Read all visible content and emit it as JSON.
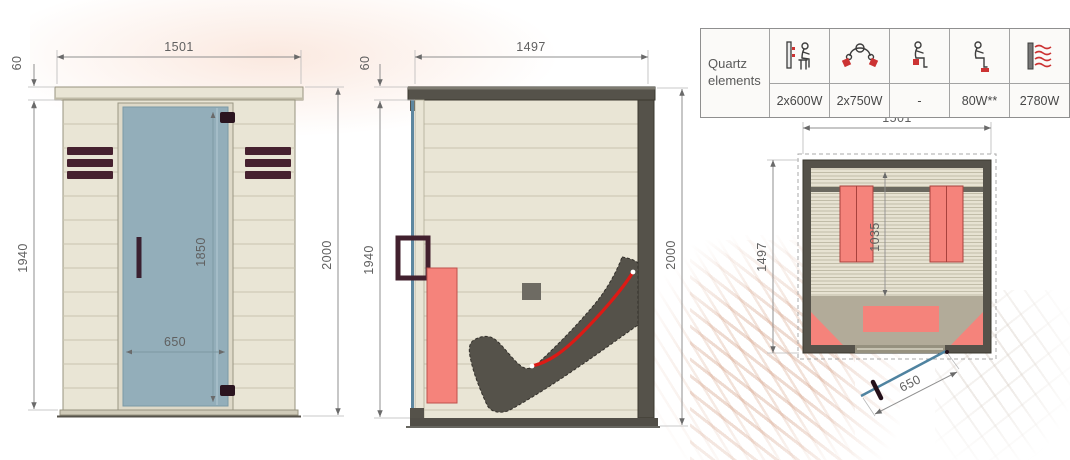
{
  "front": {
    "label": "front view",
    "dims": {
      "width": "1501",
      "roof": "60",
      "height": "1940",
      "door_height": "1850",
      "door_width": "650",
      "total_height": "2000"
    }
  },
  "side": {
    "label": "side view",
    "dims": {
      "depth": "1497",
      "roof": "60",
      "height": "1940",
      "total_height": "2000"
    }
  },
  "top": {
    "label": "top view",
    "dims": {
      "width": "1501",
      "depth": "1497",
      "bench_depth": "1035",
      "door_width": "650"
    }
  },
  "quartz_table": {
    "header": "Quartz elements",
    "columns": [
      {
        "icon": "back-heater-icon",
        "value": "2x600W"
      },
      {
        "icon": "calf-heater-icon",
        "value": "2x750W"
      },
      {
        "icon": "seat-heater-icon",
        "value": "-"
      },
      {
        "icon": "foot-heater-icon",
        "value": "80W**"
      },
      {
        "icon": "total-radiation-icon",
        "value": "2780W"
      }
    ]
  },
  "colors": {
    "wood_panel": "#e9e5d5",
    "plank_line": "#c9c4ae",
    "dark_frame": "#55524a",
    "vent_maroon": "#46212f",
    "door_glass": "#93aeba",
    "heater_red": "#f5837b",
    "heat_line_red": "#dd1a15",
    "dimension_gray": "#8f8f8f"
  }
}
